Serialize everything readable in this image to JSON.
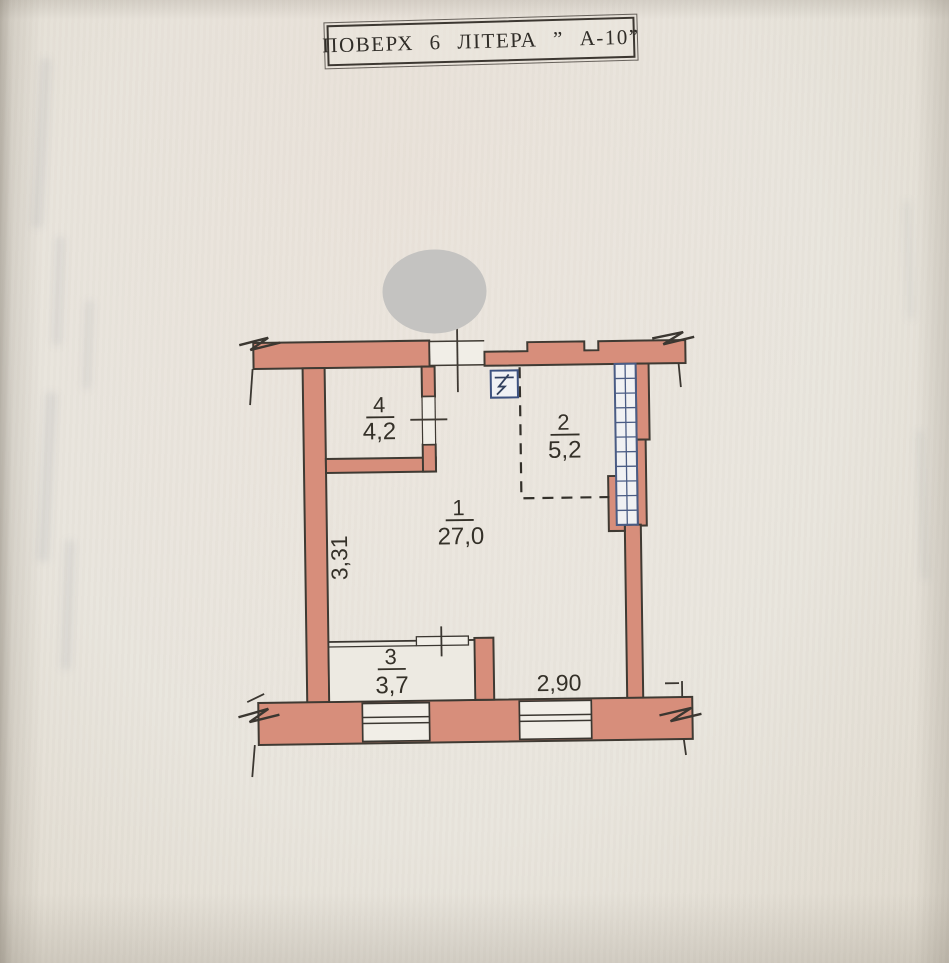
{
  "title_block": {
    "text": "ПОВЕРХ  6  ЛІТЕРА  ” А-10”"
  },
  "floor_plan": {
    "rooms": [
      {
        "number": "4",
        "area": "4,2"
      },
      {
        "number": "2",
        "area": "5,2"
      },
      {
        "number": "1",
        "area": "27,0"
      },
      {
        "number": "3",
        "area": "3,7"
      }
    ],
    "dimensions": {
      "left_height": "3,31",
      "bottom_width": "2,90"
    },
    "symbols": {
      "electric_panel": "lightning-bolt-in-box",
      "ventilation_shaft": "blue-grid-column",
      "wall_breaks": "zigzag-break-marks",
      "redaction": "grey-ellipse"
    },
    "colors": {
      "wall_fill": "#d78e7b",
      "wall_line": "#3f3a33",
      "shaft_blue": "#4a5c84",
      "paper": "#e9e5dd",
      "redaction_grey": "#c4c3c1"
    }
  }
}
